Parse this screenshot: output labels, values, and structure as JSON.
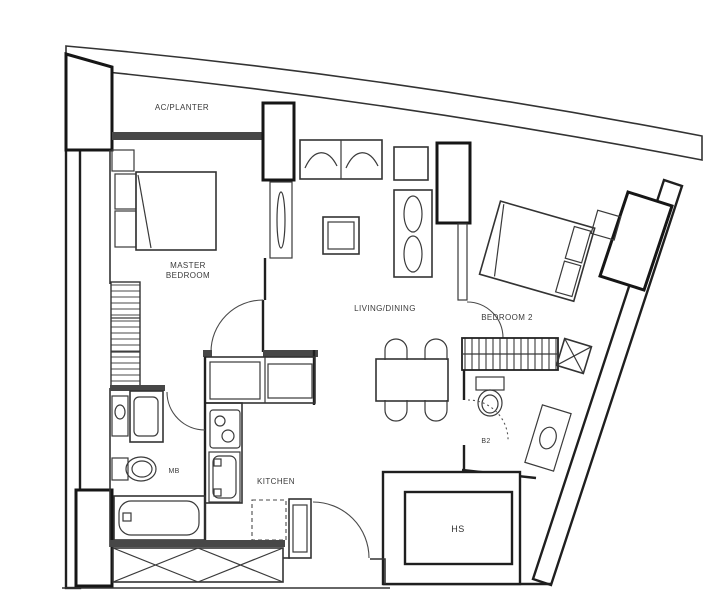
{
  "plan": {
    "rooms": {
      "ac_planter": {
        "label": "AC/PLANTER"
      },
      "master_bedroom": {
        "label_line1": "MASTER",
        "label_line2": "BEDROOM"
      },
      "living_dining": {
        "label": "LIVING/DINING"
      },
      "bedroom_2": {
        "label": "BEDROOM 2"
      },
      "kitchen": {
        "label": "KITCHEN"
      },
      "master_bath": {
        "label": "MB"
      },
      "bath_2": {
        "label": "B2"
      },
      "household_shelter": {
        "label": "HS"
      }
    },
    "colors": {
      "line": "#3a3a3a",
      "wall": "#1f1f1f",
      "solid_wall_fill": "#474747",
      "background": "#ffffff"
    }
  }
}
